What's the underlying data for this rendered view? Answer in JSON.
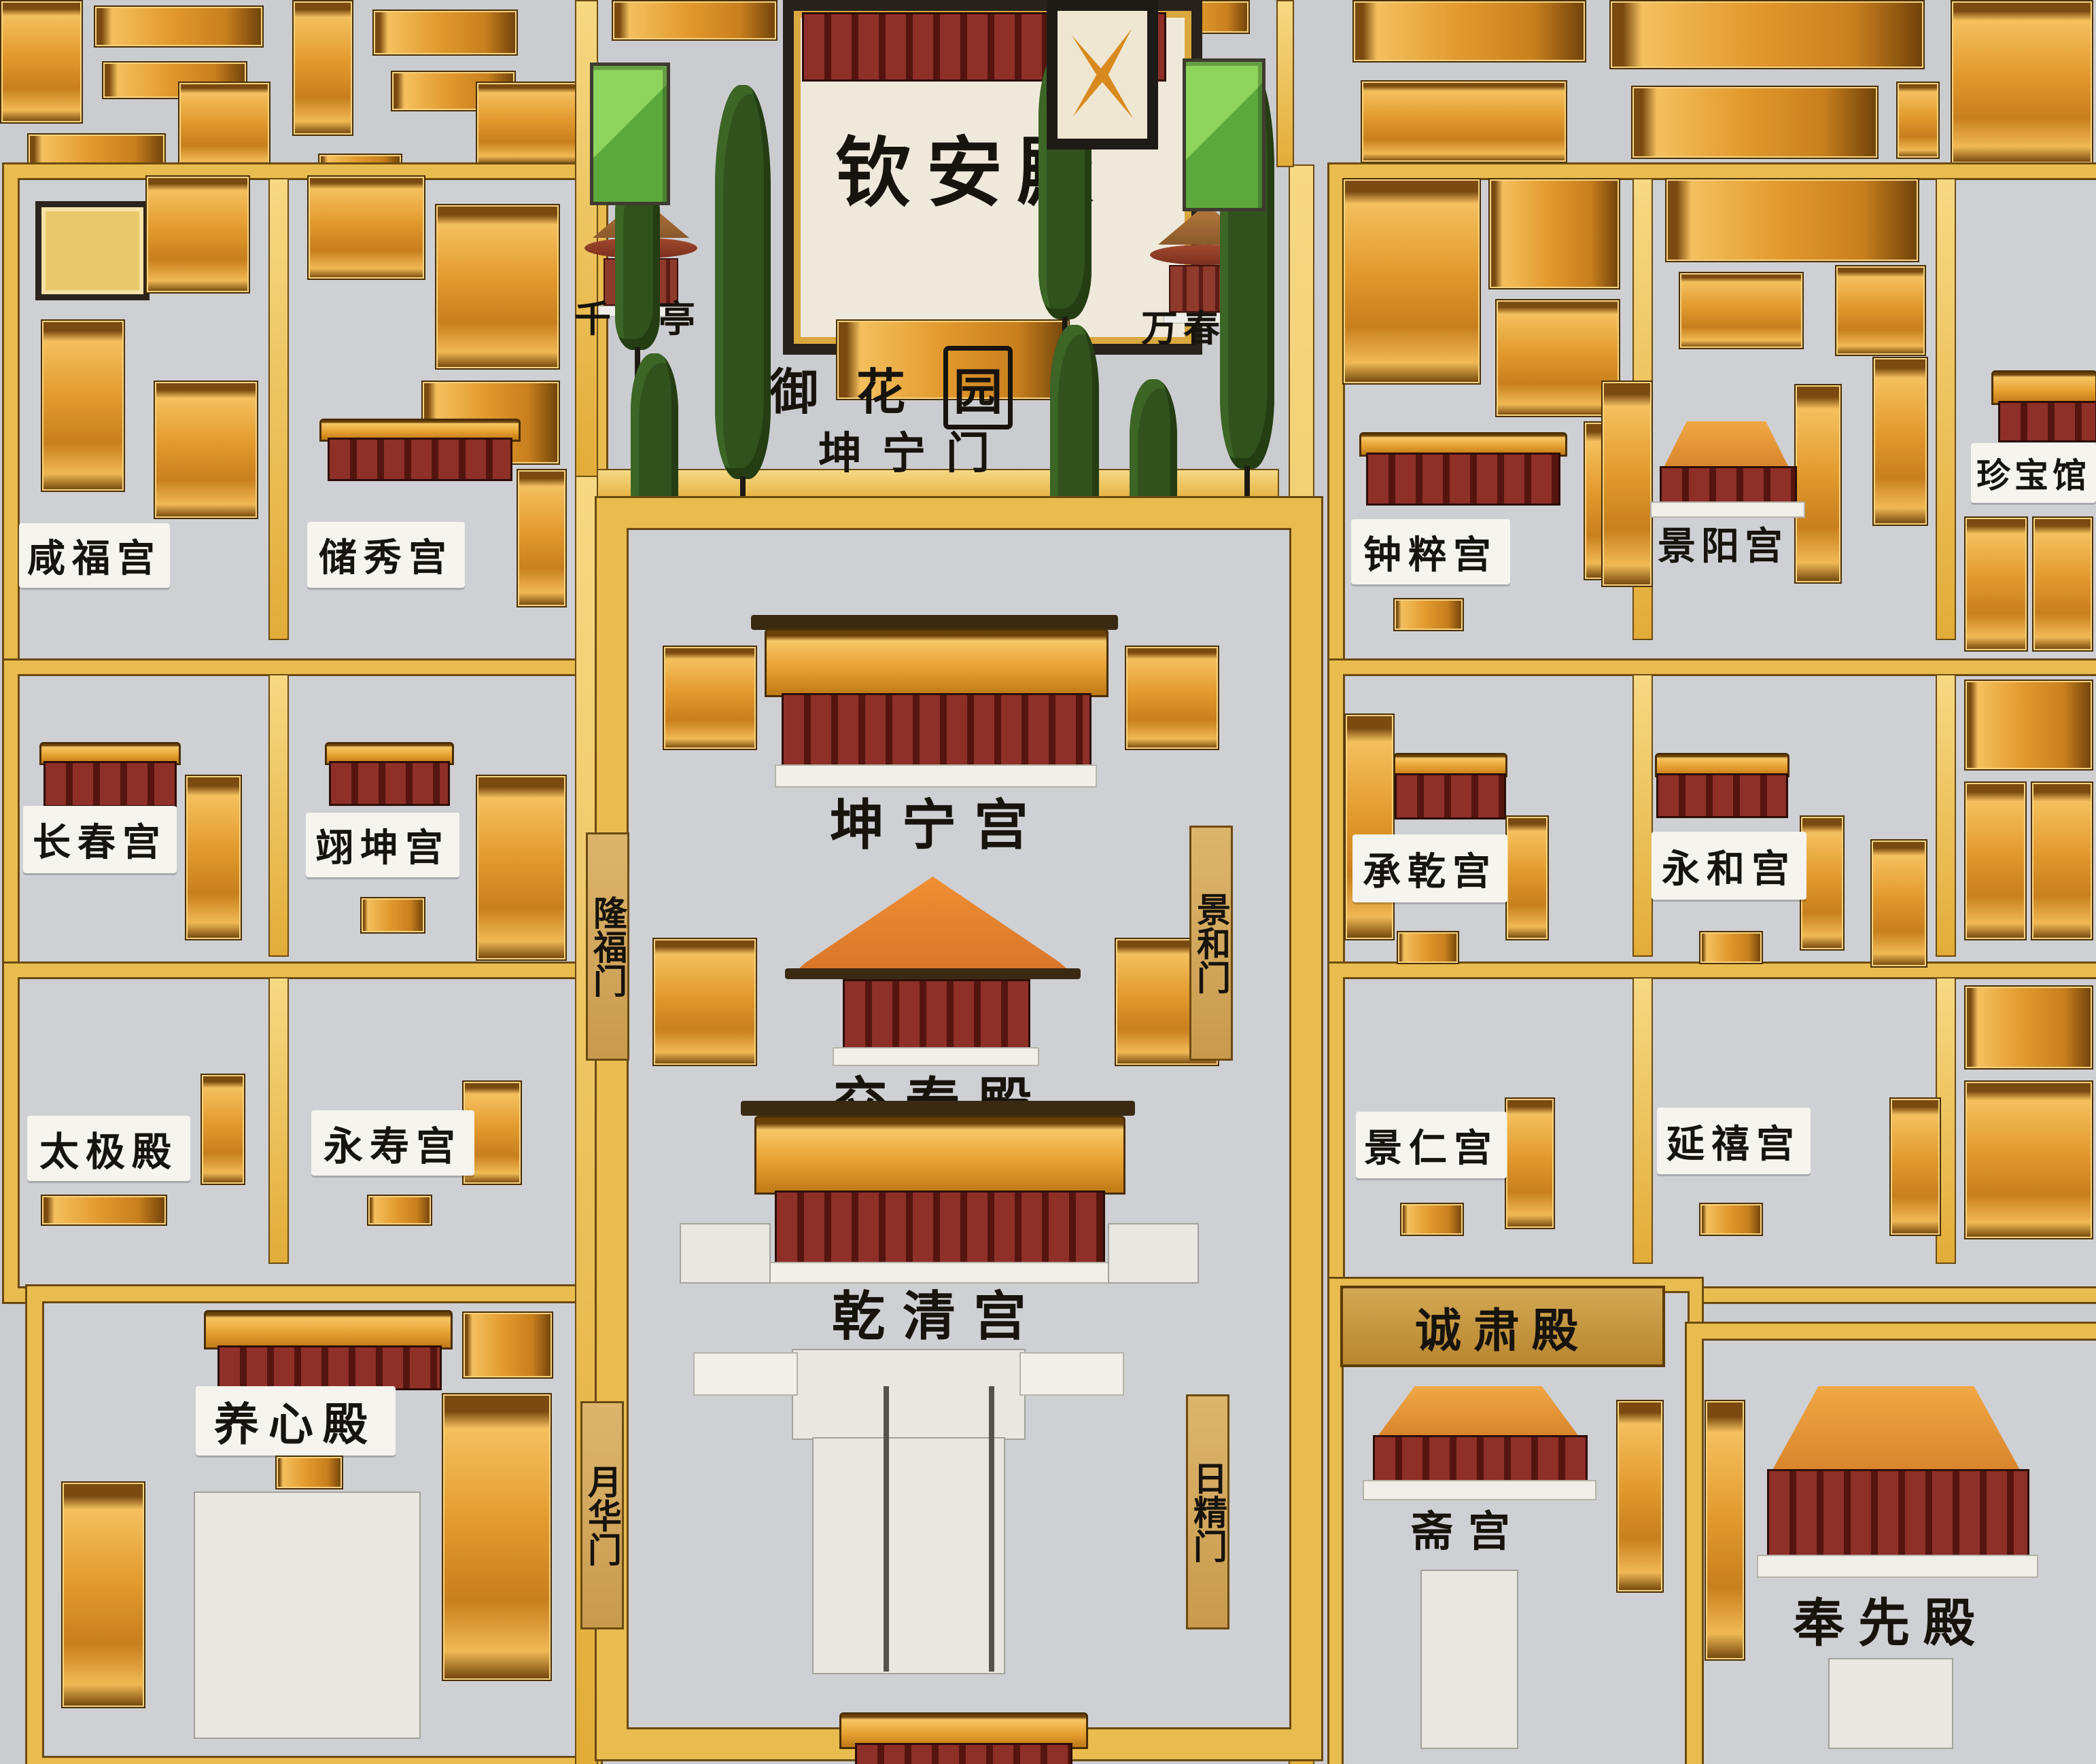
{
  "colors": {
    "wall_gold": "#e9bc4f",
    "roof_orange": "#e29a2e",
    "facade_red": "#8e2f28",
    "tree_green": "#31511d",
    "background_grey": "#cbccd0",
    "plaque_white": "#f5f4ef",
    "ink_black": "#17130d",
    "legend_green": "#8cd45c"
  },
  "garden": {
    "qin_an_dian": "钦安殿",
    "qian_qiu_ting": "千秋亭",
    "wan_chun_ting": "万春亭",
    "yu": "御",
    "hua": "花",
    "yuan": "园",
    "kun_ning_men": "坤宁门"
  },
  "central_axis": {
    "kun_ning_gong": "坤宁宫",
    "jiao_tai_dian": "交泰殿",
    "qian_qing_gong": "乾清宫"
  },
  "gates": {
    "long_fu_men": "隆福门",
    "jing_he_men": "景和门",
    "yue_hua_men": "月华门",
    "ri_jing_men": "日精门"
  },
  "west": {
    "xianfugong": "咸福宫",
    "chuxiugong": "储秀宫",
    "changchungong": "长春宫",
    "yikungong": "翊坤宫",
    "taijidian": "太极殿",
    "yongshougong": "永寿宫",
    "yangxindian": "养心殿"
  },
  "east": {
    "zhongcuigong": "钟粹宫",
    "jingyanggong": "景阳宫",
    "zhenbaoguan": "珍宝馆",
    "chengqiangong": "承乾宫",
    "yonghegong": "永和宫",
    "jingrengong": "景仁宫",
    "yanxigong": "延禧宫",
    "chengsudian": "诚肃殿",
    "zhaigong": "斋宫",
    "fengxiandian": "奉先殿"
  }
}
